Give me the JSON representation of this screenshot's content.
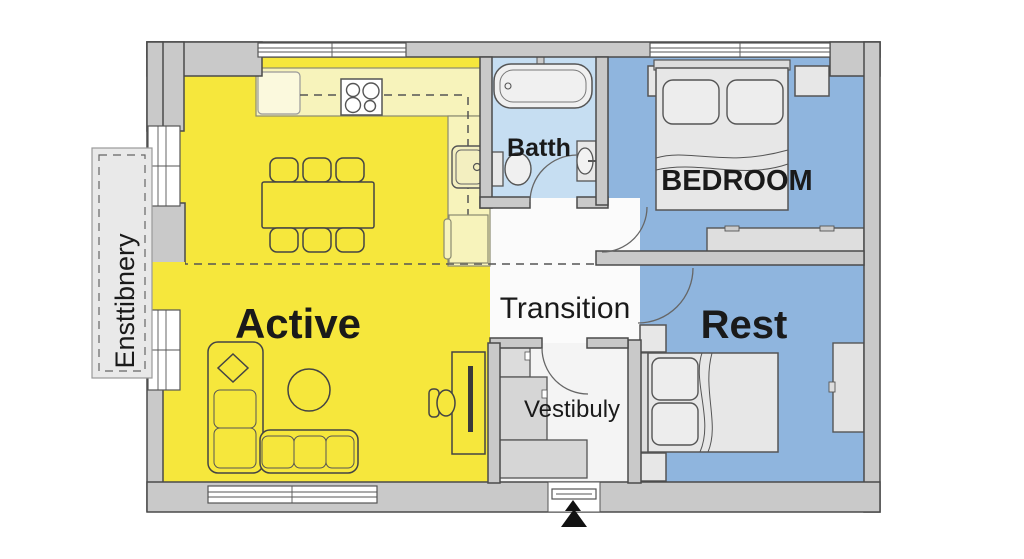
{
  "labels": {
    "active": "Active",
    "transition": "Transition",
    "rest": "Rest",
    "bedroom": "BEDROOM",
    "bath": "Batth",
    "vestibule": "Vestibuly",
    "balcony": "Ensttibnery"
  },
  "colors": {
    "active_zone": "#f6e73c",
    "kitchen_counter": "#f7f3bb",
    "counter_light": "#fbf9dd",
    "rest_zone": "#8fb5de",
    "bath_zone": "#c6def2",
    "hallway_floor": "#fbfbfb",
    "vestibule_floor": "#f4f4f4",
    "wall": "#c9c9c9",
    "balcony_floor": "#e9e9e9",
    "entrance_arrow": "#111111"
  }
}
